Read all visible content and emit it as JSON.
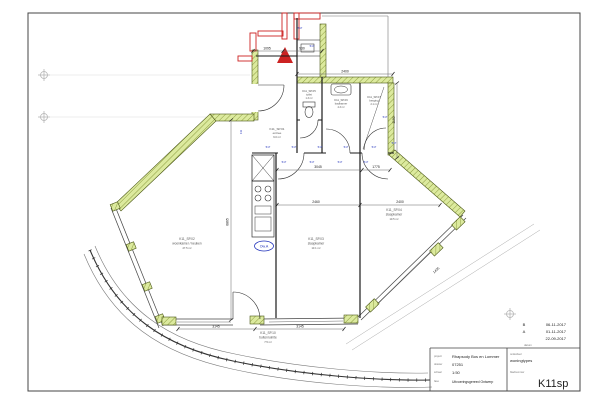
{
  "sheet": {
    "revisions": [
      {
        "letter": "B",
        "date": "06-11-2017"
      },
      {
        "letter": "A",
        "date": "01-11-2017"
      },
      {
        "letter": "",
        "date": "22-09-2017"
      }
    ],
    "datum_label": "datum",
    "titleblock": {
      "project_label": "project",
      "project": "Rhapsody Bos en Lommer",
      "dossier_label": "dossier",
      "dossier": "07251",
      "schaal_label": "schaal",
      "schaal": "1:50",
      "fase_label": "fase",
      "fase": "Uitvoeringsgereed Ontwerp",
      "onderdeel_label": "onderdeel",
      "onderdeel": "woningtypes",
      "bladnummer_label": "bladnummer",
      "bladnummer": "K11sp"
    }
  },
  "plan": {
    "rooms": [
      {
        "code": "K11_SP.01",
        "name": "entree",
        "area": "6.0 m²"
      },
      {
        "code": "K11_SP.05",
        "name": "toilet",
        "area": "1.3 m²"
      },
      {
        "code": "K11_SP.06",
        "name": "badkamer",
        "area": "4.3 m²"
      },
      {
        "code": "K11_SP.07",
        "name": "berging",
        "area": "2.1 m²"
      },
      {
        "code": "K11_SP.02",
        "name": "woonkamer / keuken",
        "area": "27.5 m²"
      },
      {
        "code": "K11_SP.03",
        "name": "slaapkamer",
        "area": "13.1 m²"
      },
      {
        "code": "K11_SP.04",
        "name": "slaapkamer",
        "area": "10.5 m²"
      },
      {
        "code": "K11_SP.10",
        "name": "buitenruimte",
        "area": "7.5 m²"
      }
    ],
    "dims": {
      "total_height": "6865",
      "top_a": "1095",
      "top_b": "930",
      "top_c": "2400",
      "corridor_a": "3045",
      "corridor_b": "1775",
      "room3_w": "2460",
      "room4_w": "2400",
      "bottom_a": "3145",
      "bottom_b": "3145",
      "facade_right": "1435",
      "utility_h": "1190"
    },
    "annotations": {
      "kitchen_unit": "Ow.A",
      "socket": "517",
      "shaft": "111"
    }
  },
  "colors": {
    "wall_green": "#dcea9e",
    "wall_hatch": "#7a8a2a",
    "wall_red": "#cc2222",
    "annotation_blue": "#2233bb"
  }
}
